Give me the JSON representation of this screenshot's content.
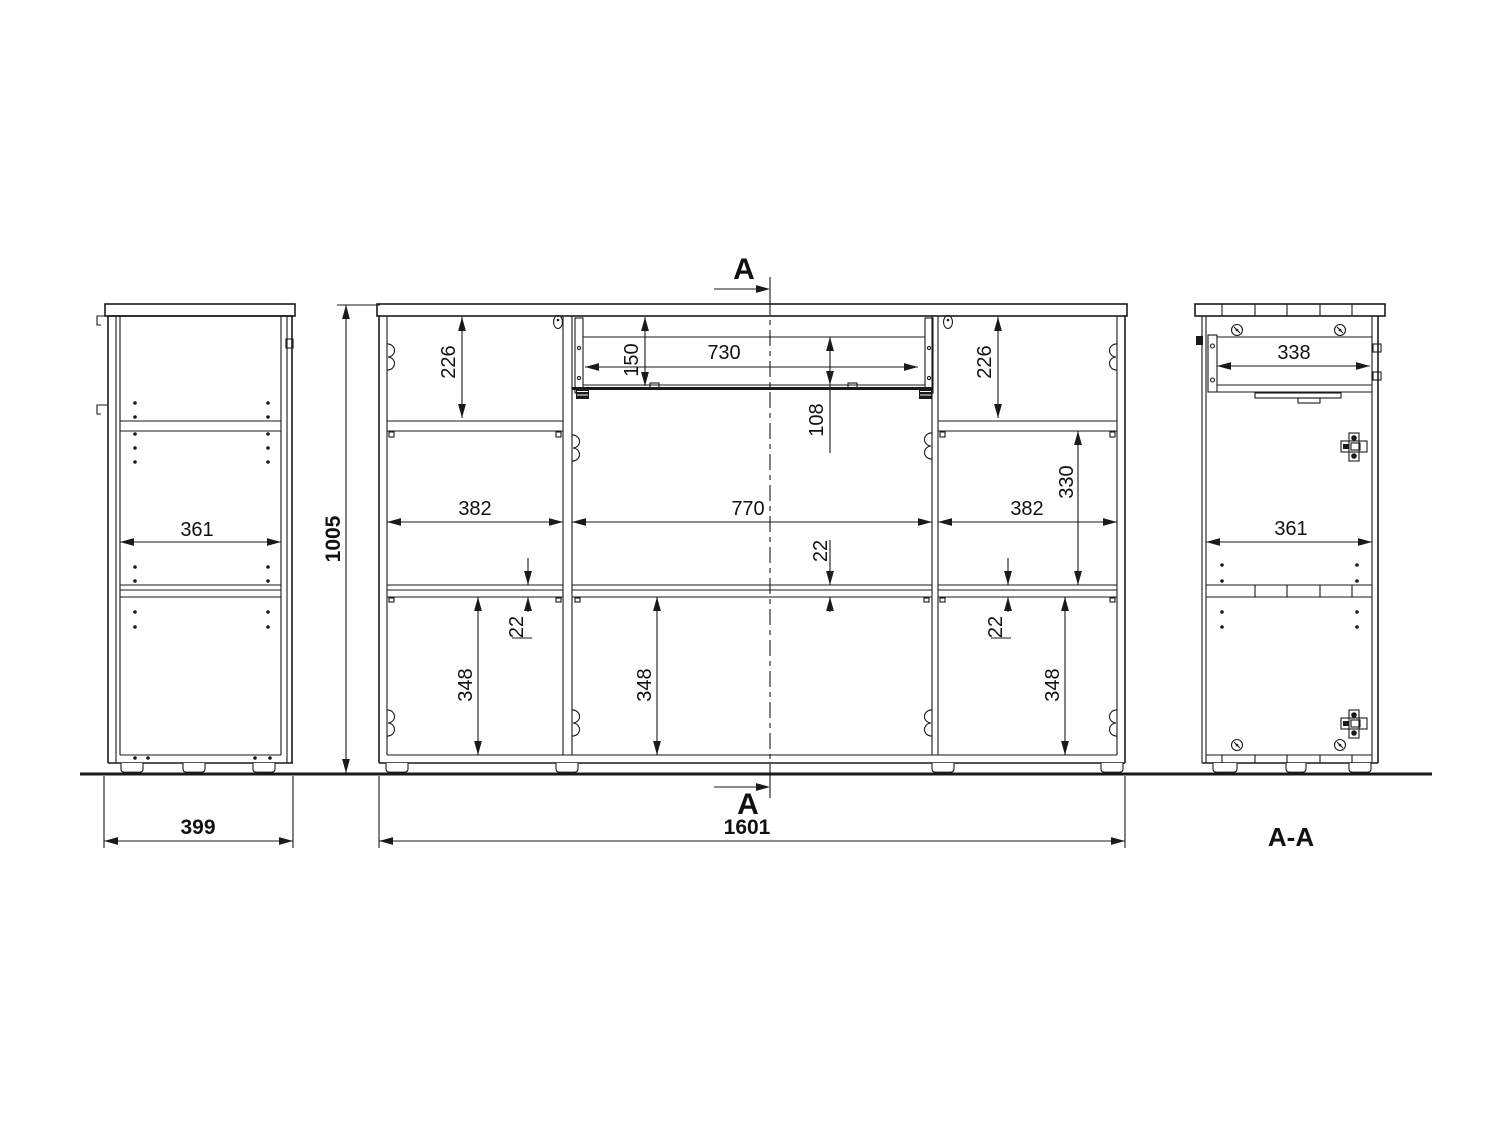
{
  "side_view": {
    "inner_width": "361",
    "depth": "399"
  },
  "front_view": {
    "height": "1005",
    "width": "1601",
    "top_left": "226",
    "top_right": "226",
    "drawer_front": "150",
    "drawer_width": "730",
    "drawer_depth": "108",
    "right_gap": "330",
    "left_width": "382",
    "center_width": "770",
    "right_width": "382",
    "shelf_left": "22",
    "shelf_center": "22",
    "shelf_right": "22",
    "door_left": "348",
    "door_center": "348",
    "door_right": "348",
    "section_marker_top": "A",
    "section_marker_bottom": "A"
  },
  "section_view": {
    "title": "A-A",
    "drawer_width": "338",
    "inner_width": "361"
  },
  "colors": {
    "line": "#1a1a1a",
    "background": "#ffffff"
  }
}
